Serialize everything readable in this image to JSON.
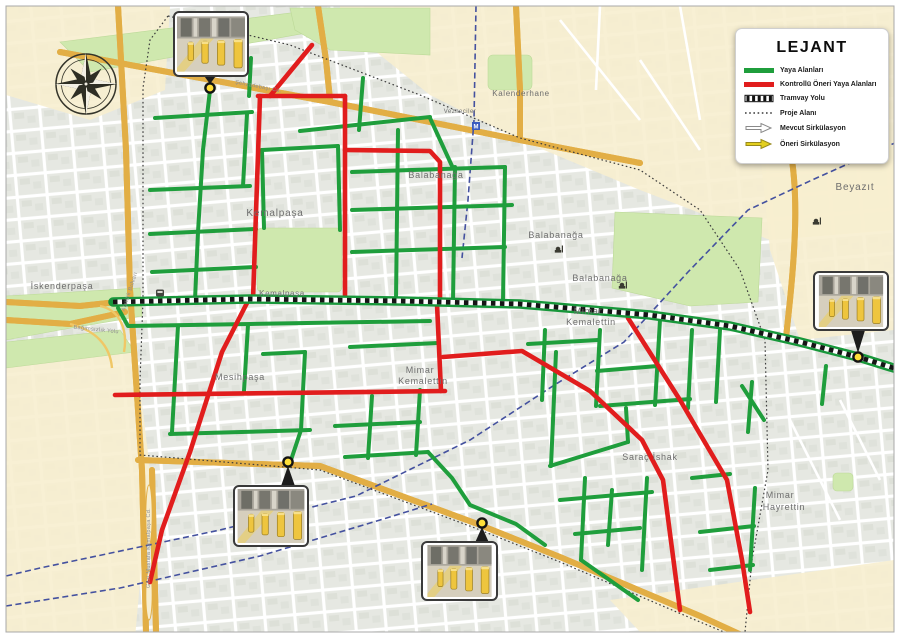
{
  "legend": {
    "title": "LEJANT",
    "items": [
      {
        "label": "Yaya Alanları",
        "swatch": "green-line",
        "color": "#1f9e3c"
      },
      {
        "label": "Kontrollü Öneri Yaya Alanları",
        "swatch": "red-line",
        "color": "#e11d1d"
      },
      {
        "label": "Tramvay Yolu",
        "swatch": "checker-line",
        "color": "#111111"
      },
      {
        "label": "Proje Alanı",
        "swatch": "dotted-line",
        "color": "#555555"
      },
      {
        "label": "Mevcut Sirkülasyon",
        "swatch": "arrow-outline",
        "color": "#ffffff"
      },
      {
        "label": "Öneri Sirkülasyon",
        "swatch": "arrow-yellow",
        "color": "#e3cf1e"
      }
    ]
  },
  "map_data": {
    "colors": {
      "pedestrian_green": "#1f9e3c",
      "controlled_red": "#e11d1d",
      "tram_black": "#151515",
      "railway_blue": "#44519f",
      "pin_yellow": "#ffdf38",
      "major_road_yellow": "#fadd7d",
      "park_green": "#cfe8ae",
      "district_cream": "#f7eecf"
    },
    "avenue": [
      [
        113,
        302
      ],
      [
        250,
        299
      ],
      [
        400,
        301
      ],
      [
        520,
        304
      ],
      [
        650,
        315
      ],
      [
        730,
        326
      ],
      [
        800,
        342
      ],
      [
        858,
        357
      ],
      [
        897,
        369
      ]
    ],
    "green_routes": [
      [
        [
          210,
          90
        ],
        [
          203,
          150
        ]
      ],
      [
        [
          155,
          118
        ],
        [
          252,
          112
        ]
      ],
      [
        [
          203,
          150
        ],
        [
          198,
          232
        ]
      ],
      [
        [
          150,
          190
        ],
        [
          250,
          186
        ]
      ],
      [
        [
          150,
          234
        ],
        [
          256,
          229
        ]
      ],
      [
        [
          247,
          114
        ],
        [
          243,
          186
        ]
      ],
      [
        [
          251,
          58
        ],
        [
          249,
          96
        ]
      ],
      [
        [
          262,
          150
        ],
        [
          338,
          146
        ]
      ],
      [
        [
          262,
          150
        ],
        [
          264,
          228
        ]
      ],
      [
        [
          338,
          146
        ],
        [
          340,
          230
        ]
      ],
      [
        [
          363,
          78
        ],
        [
          359,
          130
        ]
      ],
      [
        [
          300,
          131
        ],
        [
          430,
          117
        ]
      ],
      [
        [
          430,
          118
        ],
        [
          452,
          166
        ]
      ],
      [
        [
          352,
          172
        ],
        [
          505,
          167
        ]
      ],
      [
        [
          352,
          210
        ],
        [
          512,
          205
        ]
      ],
      [
        [
          352,
          252
        ],
        [
          505,
          247
        ]
      ],
      [
        [
          398,
          130
        ],
        [
          396,
          300
        ]
      ],
      [
        [
          455,
          167
        ],
        [
          453,
          302
        ]
      ],
      [
        [
          505,
          167
        ],
        [
          503,
          302
        ]
      ],
      [
        [
          152,
          272
        ],
        [
          256,
          267
        ]
      ],
      [
        [
          198,
          232
        ],
        [
          195,
          300
        ]
      ],
      [
        [
          118,
          308
        ],
        [
          128,
          326
        ],
        [
          250,
          324
        ],
        [
          430,
          321
        ]
      ],
      [
        [
          178,
          326
        ],
        [
          172,
          432
        ]
      ],
      [
        [
          305,
          352
        ],
        [
          301,
          430
        ],
        [
          291,
          460
        ]
      ],
      [
        [
          170,
          434
        ],
        [
          310,
          430
        ]
      ],
      [
        [
          248,
          325
        ],
        [
          244,
          391
        ]
      ],
      [
        [
          263,
          354
        ],
        [
          305,
          352
        ]
      ],
      [
        [
          372,
          396
        ],
        [
          368,
          458
        ]
      ],
      [
        [
          335,
          426
        ],
        [
          420,
          422
        ]
      ],
      [
        [
          345,
          457
        ],
        [
          428,
          452
        ]
      ],
      [
        [
          420,
          390
        ],
        [
          416,
          455
        ]
      ],
      [
        [
          350,
          347
        ],
        [
          438,
          343
        ]
      ],
      [
        [
          545,
          330
        ],
        [
          542,
          400
        ]
      ],
      [
        [
          600,
          330
        ],
        [
          596,
          406
        ]
      ],
      [
        [
          528,
          344
        ],
        [
          598,
          340
        ]
      ],
      [
        [
          597,
          371
        ],
        [
          658,
          366
        ]
      ],
      [
        [
          660,
          320
        ],
        [
          655,
          405
        ]
      ],
      [
        [
          692,
          330
        ],
        [
          688,
          408
        ]
      ],
      [
        [
          600,
          406
        ],
        [
          690,
          399
        ]
      ],
      [
        [
          720,
          330
        ],
        [
          716,
          402
        ]
      ],
      [
        [
          556,
          352
        ],
        [
          551,
          466
        ]
      ],
      [
        [
          550,
          466
        ],
        [
          628,
          442
        ]
      ],
      [
        [
          628,
          442
        ],
        [
          626,
          408
        ]
      ],
      [
        [
          585,
          478
        ],
        [
          581,
          560
        ]
      ],
      [
        [
          560,
          500
        ],
        [
          652,
          492
        ]
      ],
      [
        [
          575,
          534
        ],
        [
          640,
          528
        ]
      ],
      [
        [
          647,
          478
        ],
        [
          642,
          570
        ]
      ],
      [
        [
          612,
          490
        ],
        [
          608,
          545
        ]
      ],
      [
        [
          581,
          560
        ],
        [
          638,
          600
        ]
      ],
      [
        [
          692,
          478
        ],
        [
          730,
          474
        ]
      ],
      [
        [
          755,
          488
        ],
        [
          750,
          570
        ]
      ],
      [
        [
          700,
          532
        ],
        [
          754,
          526
        ]
      ],
      [
        [
          710,
          570
        ],
        [
          753,
          565
        ]
      ],
      [
        [
          428,
          452
        ],
        [
          452,
          478
        ],
        [
          470,
          505
        ],
        [
          516,
          524
        ],
        [
          545,
          545
        ]
      ],
      [
        [
          742,
          386
        ],
        [
          764,
          420
        ]
      ],
      [
        [
          752,
          382
        ],
        [
          748,
          432
        ]
      ],
      [
        [
          826,
          366
        ],
        [
          822,
          404
        ]
      ]
    ],
    "red_routes": [
      [
        [
          260,
          96
        ],
        [
          253,
          300
        ]
      ],
      [
        [
          345,
          96
        ],
        [
          345,
          301
        ]
      ],
      [
        [
          258,
          96
        ],
        [
          345,
          96
        ]
      ],
      [
        [
          312,
          45
        ],
        [
          270,
          96
        ]
      ],
      [
        [
          345,
          150
        ],
        [
          430,
          151
        ],
        [
          440,
          162
        ],
        [
          440,
          300
        ]
      ],
      [
        [
          248,
          301
        ],
        [
          222,
          352
        ],
        [
          190,
          452
        ],
        [
          162,
          530
        ],
        [
          150,
          582
        ]
      ],
      [
        [
          115,
          395
        ],
        [
          445,
          391
        ]
      ],
      [
        [
          437,
          304
        ],
        [
          441,
          391
        ]
      ],
      [
        [
          443,
          357
        ],
        [
          522,
          351
        ],
        [
          590,
          391
        ],
        [
          642,
          440
        ],
        [
          663,
          480
        ],
        [
          680,
          610
        ]
      ],
      [
        [
          628,
          318
        ],
        [
          680,
          400
        ],
        [
          727,
          480
        ],
        [
          742,
          560
        ],
        [
          750,
          612
        ]
      ]
    ],
    "railway": [
      [
        [
          897,
          142
        ],
        [
          812,
          180
        ],
        [
          748,
          210
        ],
        [
          688,
          272
        ],
        [
          624,
          342
        ],
        [
          556,
          384
        ],
        [
          470,
          440
        ],
        [
          356,
          496
        ],
        [
          220,
          530
        ],
        [
          40,
          568
        ],
        [
          6,
          576
        ]
      ],
      [
        [
          6,
          606
        ],
        [
          120,
          588
        ],
        [
          260,
          556
        ],
        [
          380,
          520
        ],
        [
          432,
          504
        ]
      ],
      [
        [
          476,
          6
        ],
        [
          474,
          120
        ],
        [
          468,
          200
        ],
        [
          462,
          258
        ]
      ]
    ],
    "project_boundary": [
      [
        [
          168,
          16
        ],
        [
          290,
          45
        ],
        [
          420,
          95
        ],
        [
          520,
          138
        ],
        [
          640,
          170
        ],
        [
          700,
          210
        ],
        [
          740,
          270
        ],
        [
          765,
          340
        ],
        [
          768,
          470
        ],
        [
          752,
          560
        ],
        [
          745,
          632
        ]
      ],
      [
        [
          168,
          16
        ],
        [
          150,
          40
        ],
        [
          143,
          88
        ],
        [
          143,
          300
        ],
        [
          140,
          380
        ],
        [
          140,
          455
        ],
        [
          320,
          470
        ],
        [
          475,
          528
        ],
        [
          560,
          562
        ],
        [
          700,
          622
        ],
        [
          738,
          638
        ]
      ]
    ],
    "pins": [
      [
        210,
        88
      ],
      [
        858,
        357
      ],
      [
        288,
        462
      ],
      [
        482,
        523
      ]
    ],
    "callouts": [
      {
        "x": 174,
        "y": 12,
        "w": 74,
        "h": 64,
        "tip": [
          210,
          84
        ]
      },
      {
        "x": 814,
        "y": 272,
        "w": 74,
        "h": 58,
        "tip": [
          858,
          353
        ]
      },
      {
        "x": 234,
        "y": 486,
        "w": 74,
        "h": 60,
        "tip": [
          288,
          466
        ]
      },
      {
        "x": 422,
        "y": 542,
        "w": 75,
        "h": 58,
        "tip": [
          482,
          527
        ]
      }
    ],
    "icons": [
      {
        "type": "mosque",
        "x": 558,
        "y": 250
      },
      {
        "type": "mosque",
        "x": 622,
        "y": 286
      },
      {
        "type": "mosque",
        "x": 816,
        "y": 222
      },
      {
        "type": "bus",
        "x": 160,
        "y": 293
      },
      {
        "type": "metro",
        "x": 476,
        "y": 126
      }
    ],
    "place_labels": [
      {
        "t": "Kemalpaşa",
        "x": 275,
        "y": 216,
        "s": 10
      },
      {
        "t": "Kemalpaşa",
        "x": 282,
        "y": 296,
        "s": 8
      },
      {
        "t": "Balabanağa",
        "x": 436,
        "y": 178,
        "s": 9
      },
      {
        "t": "Balabanağa",
        "x": 556,
        "y": 238,
        "s": 9
      },
      {
        "t": "Balabanağa",
        "x": 600,
        "y": 281,
        "s": 9
      },
      {
        "t": "Mimar",
        "x": 588,
        "y": 314,
        "s": 9
      },
      {
        "t": "Kemalettin",
        "x": 591,
        "y": 325,
        "s": 9
      },
      {
        "t": "Mimar",
        "x": 420,
        "y": 373,
        "s": 9
      },
      {
        "t": "Kemalettin",
        "x": 423,
        "y": 384,
        "s": 9
      },
      {
        "t": "Mesihpaşa",
        "x": 240,
        "y": 380,
        "s": 9
      },
      {
        "t": "İskenderpaşa",
        "x": 62,
        "y": 289,
        "s": 9
      },
      {
        "t": "Saraç İshak",
        "x": 650,
        "y": 460,
        "s": 9
      },
      {
        "t": "Beyazıt",
        "x": 855,
        "y": 190,
        "s": 10
      },
      {
        "t": "Mimar",
        "x": 780,
        "y": 498,
        "s": 9
      },
      {
        "t": "Hayrettin",
        "x": 784,
        "y": 510,
        "s": 9
      },
      {
        "t": "Kalenderhane",
        "x": 521,
        "y": 96,
        "s": 8
      },
      {
        "t": "Vezneciler",
        "x": 460,
        "y": 113,
        "s": 6,
        "c": "#4a6fd4"
      }
    ],
    "road_labels": [
      {
        "t": "Atatürk Bulvarı",
        "x": 131,
        "y": 292,
        "r": -72
      },
      {
        "t": "Gazi Mustafa Kemalpaşa Cd.",
        "x": 150,
        "y": 548,
        "r": -90
      },
      {
        "t": "Şehzadebaşı Cd.",
        "x": 258,
        "y": 88,
        "r": 11
      },
      {
        "t": "Bağımsızlık Yolu",
        "x": 96,
        "y": 331,
        "r": 6
      }
    ]
  }
}
